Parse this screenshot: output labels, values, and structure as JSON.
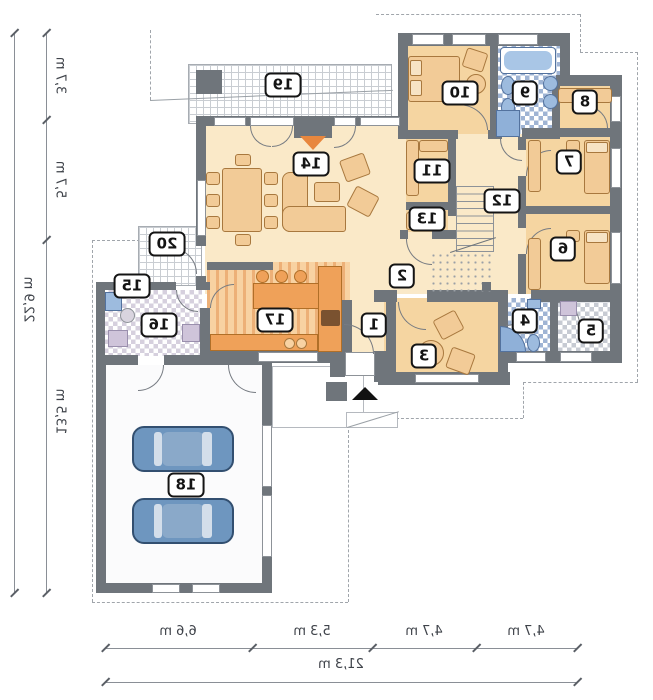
{
  "rooms": {
    "r1": "1",
    "r2": "2",
    "r3": "3",
    "r4": "4",
    "r5": "5",
    "r6": "6",
    "r7": "7",
    "r8": "8",
    "r9": "9",
    "r10": "10",
    "r11": "11",
    "r12": "12",
    "r13": "13",
    "r14": "14",
    "r15": "15",
    "r16": "16",
    "r17": "17",
    "r18": "18",
    "r19": "19",
    "r20": "20"
  },
  "dims": {
    "left": {
      "segments": [
        "3,7 m",
        "5,7 m",
        "13,5 m"
      ],
      "total": "22,9 m"
    },
    "bottom": {
      "segments": [
        "6,6 m",
        "5,3 m",
        "4,7 m",
        "4,7 m"
      ],
      "total": "21,3 m"
    }
  },
  "colors": {
    "wall": "#6F757B",
    "floor_cream": "#FAE9C8",
    "floor_peach": "#F5D5A1",
    "kitchen_stripe": "#EDB077",
    "furniture_tan": "#F2CB97",
    "furniture_orange": "#EFA159",
    "fixture_blue": "#9DBBDE",
    "car_blue": "#6E96BF",
    "checker_lavender": "#D6D0DE",
    "checker_blue": "#9FB4D4",
    "checker_gray": "#C7CBD3",
    "fireplace_orange": "#E8873E"
  }
}
